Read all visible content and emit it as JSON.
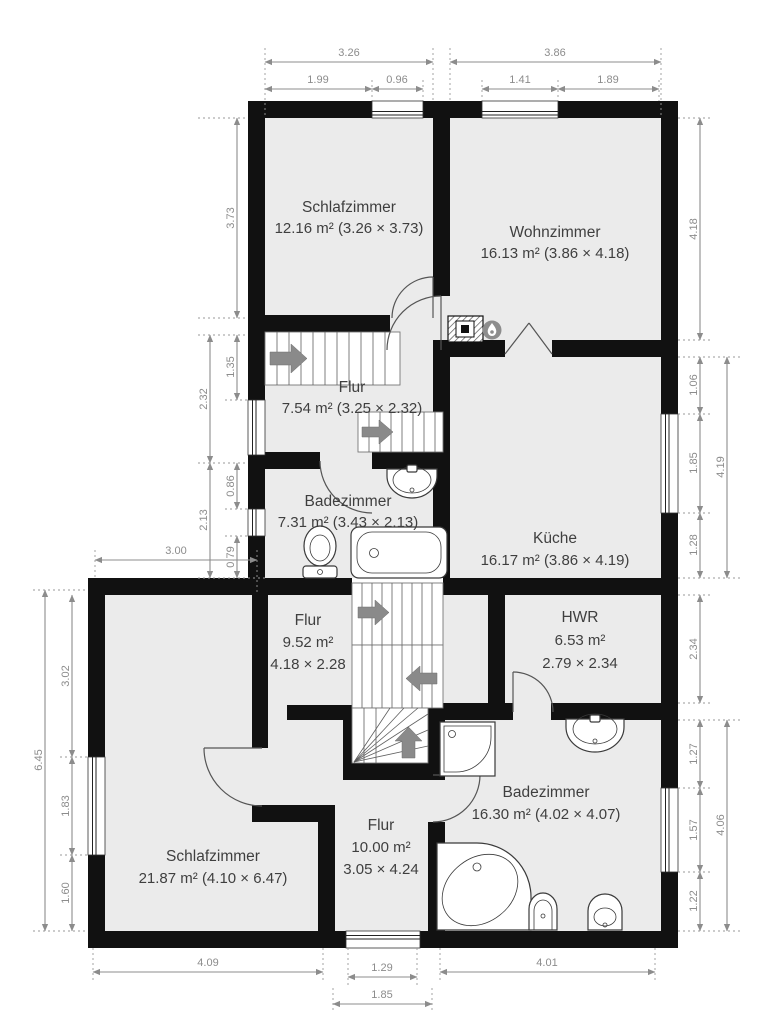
{
  "colors": {
    "wall": "#111111",
    "floor": "#ebebeb",
    "dimension_gray": "#8c8c8c",
    "label_gray": "#3f3f3f",
    "stair_arrow_gray": "#8a8a8a"
  },
  "rooms": [
    {
      "name": "Schlafzimmer",
      "area": "12.16 m² (3.26 × 3.73)"
    },
    {
      "name": "Wohnzimmer",
      "area": "16.13 m² (3.86 × 4.18)"
    },
    {
      "name": "Flur",
      "area": "7.54 m² (3.25 × 2.32)"
    },
    {
      "name": "Küche",
      "area": "16.17 m² (3.86 × 4.19)"
    },
    {
      "name": "Badezimmer",
      "area": "7.31 m² (3.43 × 2.13)"
    },
    {
      "name": "Flur",
      "area": "9.52 m²",
      "dims": "4.18 × 2.28"
    },
    {
      "name": "HWR",
      "area": "6.53 m²",
      "dims": "2.79 × 2.34"
    },
    {
      "name": "Schlafzimmer",
      "area": "21.87 m² (4.10 × 6.47)"
    },
    {
      "name": "Flur",
      "area": "10.00 m²",
      "dims": "3.05 × 4.24"
    },
    {
      "name": "Badezimmer",
      "area": "16.30 m² (4.02 × 4.07)"
    }
  ],
  "dims": {
    "top": [
      "3.26",
      "3.86",
      "1.99",
      "0.96",
      "1.41",
      "1.89"
    ],
    "left_upper": [
      "3.73",
      "1.35",
      "2.32",
      "0.86",
      "2.13",
      "0.79",
      "3.00"
    ],
    "left_lower": [
      "6.45",
      "3.02",
      "1.83",
      "1.60"
    ],
    "right": [
      "4.18",
      "1.06",
      "1.85",
      "1.28",
      "4.19",
      "2.34",
      "1.27",
      "1.57",
      "4.06",
      "1.22"
    ],
    "bottom": [
      "4.09",
      "1.29",
      "1.85",
      "4.01"
    ]
  },
  "icons": {
    "fireplace-icon": "gray circle with white flame",
    "chimney-icon": "hatched square with flue",
    "stair-direction-arrows": "gray arrows on stair flights"
  }
}
